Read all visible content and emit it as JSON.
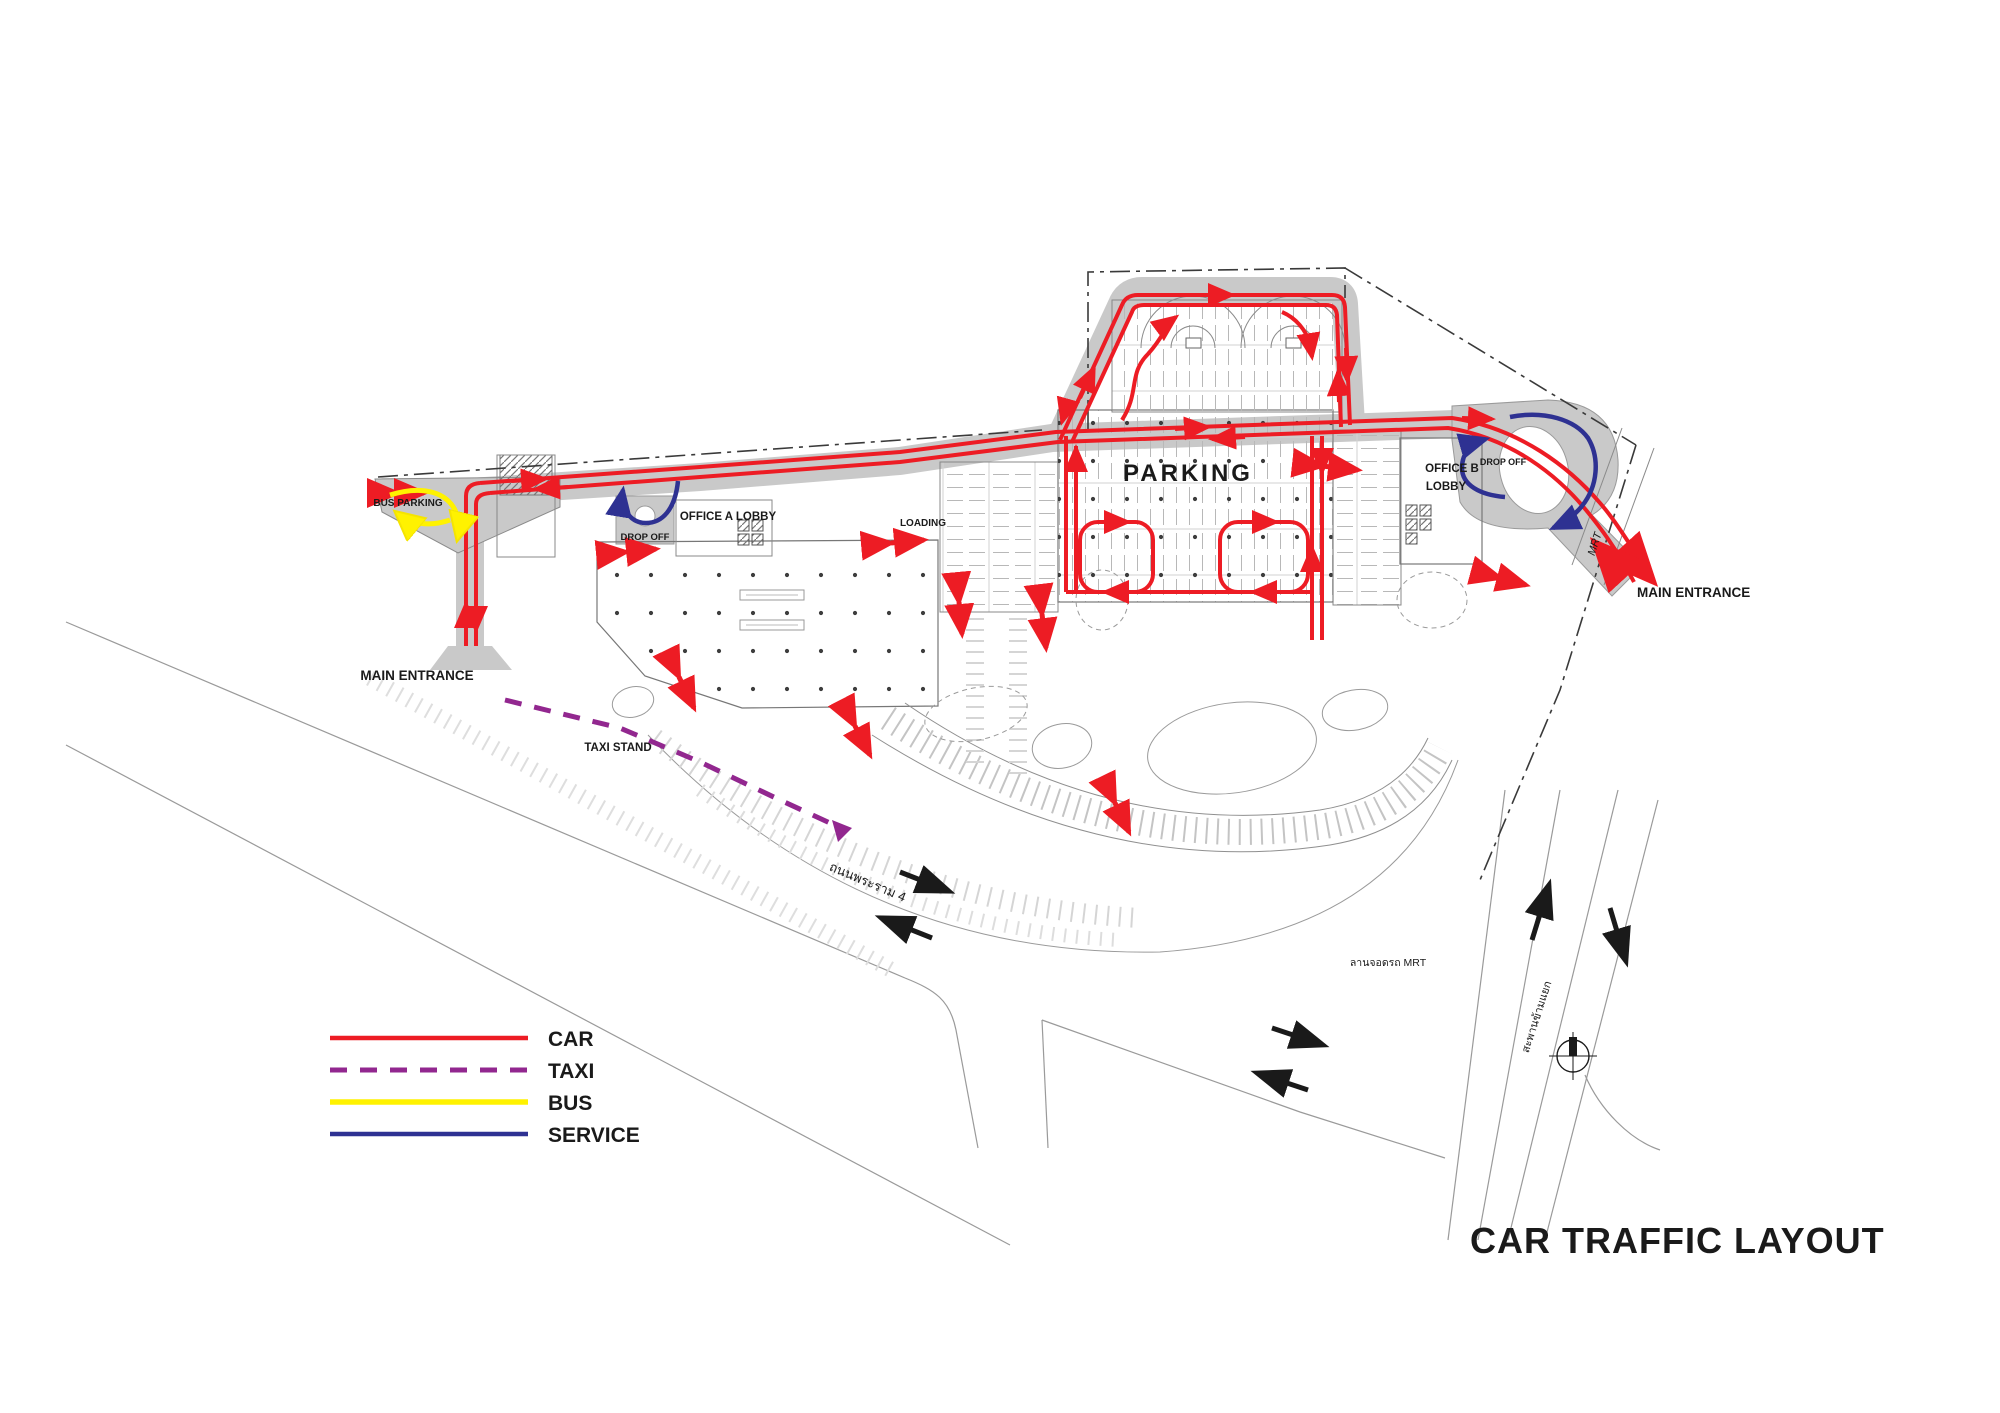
{
  "title": "CAR TRAFFIC LAYOUT",
  "legend": {
    "items": [
      {
        "label": "CAR",
        "color": "#ED1C24",
        "style": "solid"
      },
      {
        "label": "TAXI",
        "color": "#92278F",
        "style": "dashed"
      },
      {
        "label": "BUS",
        "color": "#FFF200",
        "style": "solid"
      },
      {
        "label": "SERVICE",
        "color": "#2E3192",
        "style": "solid"
      }
    ]
  },
  "labels": {
    "parking": "PARKING",
    "bus_parking": "BUS PARKING",
    "drop_off_a": "DROP OFF",
    "office_a_lobby": "OFFICE A LOBBY",
    "loading": "LOADING",
    "office_b_line1": "OFFICE B",
    "office_b_line2": "LOBBY",
    "drop_off_b": "DROP OFF",
    "mrt": "MRT",
    "main_entrance_left": "MAIN ENTRANCE",
    "main_entrance_right": "MAIN ENTRANCE",
    "taxi_stand": "TAXI STAND",
    "rama4_road": "ถนนพระราม 4",
    "mrt_parking_lot": "ลานจอดรถ MRT",
    "overpass": "สะพานข้ามแยก"
  },
  "colors": {
    "car": "#ED1C24",
    "taxi": "#92278F",
    "bus": "#FFF200",
    "service": "#2E3192",
    "road_fill": "#C9C9C9",
    "plan_line": "#8a8a8a",
    "boundary": "#3a3a3a",
    "text": "#1a1a1a"
  }
}
